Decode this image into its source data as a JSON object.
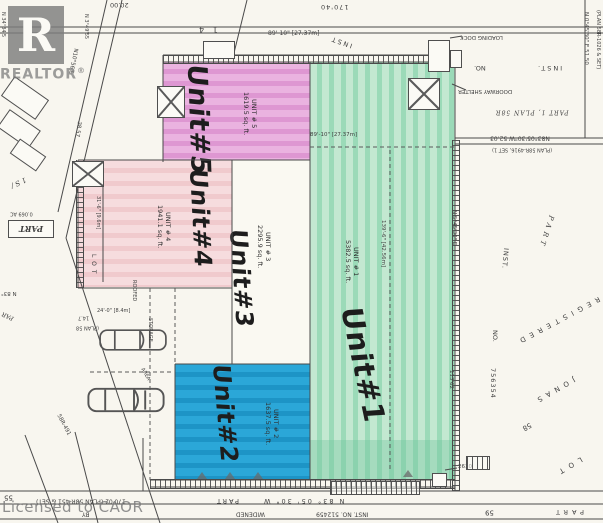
{
  "branding": {
    "realtor_letter": "R",
    "realtor_wordmark": "REALTOR",
    "registered_mark": "®",
    "license_watermark": "Licensed to CAOR"
  },
  "units": [
    {
      "number": "1",
      "handwritten": "Unit#1",
      "label": "UNIT # 1",
      "area": "5382.5 sq. ft.",
      "fill": "#a9dfc0"
    },
    {
      "number": "2",
      "handwritten": "Unit#2",
      "label": "UNIT # 2",
      "area": "1637.5 sq. ft.",
      "fill": "#2aa6d6"
    },
    {
      "number": "3",
      "handwritten": "Unit#3",
      "label": "UNIT # 3",
      "area": "2295.9 sq. ft.",
      "fill": "#faf9f2"
    },
    {
      "number": "4",
      "handwritten": "Unit#4",
      "label": "UNIT # 4",
      "area": "1941.1 sq. ft.",
      "fill": "#f4d5d8"
    },
    {
      "number": "5",
      "handwritten": "Unit#5",
      "label": "UNIT # 5",
      "area": "1619.5 sq. ft.",
      "fill": "#e5a6da"
    }
  ],
  "dimensions": {
    "top_width": "89'-10\" [27.37m]",
    "mid_width": "89'-10\" [27.37m]",
    "unit1_depth": "139'-6\" [42.56m]",
    "unit4_depth": "31'-6\" [9.6m]",
    "parking_width": "24'-0\" [8.4m]",
    "top_frontage": "170'40",
    "top_left": "20.00",
    "plan_block": "1 4",
    "road_bearing": "N10°56'E",
    "road_distance": "38.57",
    "right_top_bearing": "N 0°45'30\" E  51.50",
    "right_top_plan": "(PLAN 58R-1026 & SET)",
    "jog_bearing": "N83°05'30\"W  52.03",
    "jog_plan": "(PLAN 58R-4916, SET 1)",
    "east_bearing": "N 5°45'30\" E",
    "east_distance": "113'62",
    "bottom_distance": "170'02  (PLAN 58R-451 & SET)",
    "bottom_bearing": "N 83° 05' 30\" W",
    "bottom_left_distance": "55",
    "left_distance_1": "14.7",
    "left_plan": "(PLAN 58",
    "left_bearing_1": "N 3°49'55",
    "left_bearing_2": "N 34°34'5",
    "corner_mark": "2610",
    "diag_plan": "58R-491"
  },
  "labels": {
    "inst_top": "INST",
    "no_top": "NO.",
    "inst_top_right": "INST.",
    "loading_dock": "LOADING DOCK",
    "doorway_shelter": "DOORWAY SHELTER",
    "part_plan": "PART 1, PLAN 58R",
    "inst_mid": "INST.",
    "part_mid": "PART",
    "registered": "REGISTERED",
    "jonas": "JONAS",
    "no_right": "NO.",
    "inst_no_right": "756354",
    "lot_right": "LOT",
    "lot_58": "58",
    "lot_59": "59",
    "part_bottom_right": "PART",
    "part_road": "PART",
    "widened": "WIDENED",
    "by": "BY",
    "inst_no_bottom": "INST. NO. 512459",
    "part_box": "PART",
    "part_box_area": "0.069 AC",
    "n83_left": "N 83°",
    "part_left": "PAR",
    "lot_left": "LOT",
    "street_left": "1 S /",
    "roofed": "ROOFED",
    "storage": "STORAGE",
    "area": "AREA"
  }
}
